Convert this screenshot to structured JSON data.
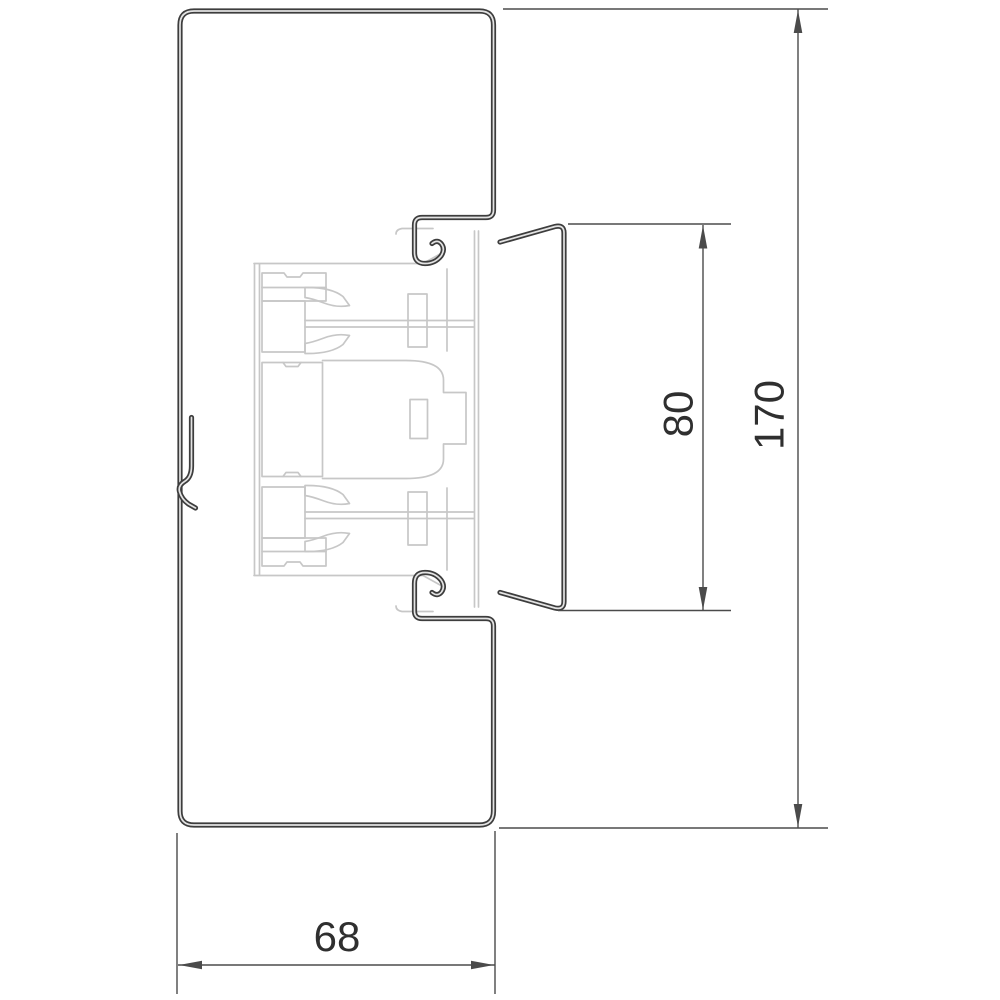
{
  "drawing": {
    "kind": "trunking-profile-cross-section",
    "dimensions": {
      "opening_height": {
        "label": "80"
      },
      "total_height": {
        "label": "170"
      },
      "depth": {
        "label": "68"
      }
    }
  },
  "colors": {
    "profile_line": "#3d3d3d",
    "line_core": "#e3e3e3",
    "dimension_line": "#4b4b4b",
    "device_line": "#c7c7c7",
    "text_color": "#2f2f2f",
    "background": "#ffffff"
  }
}
